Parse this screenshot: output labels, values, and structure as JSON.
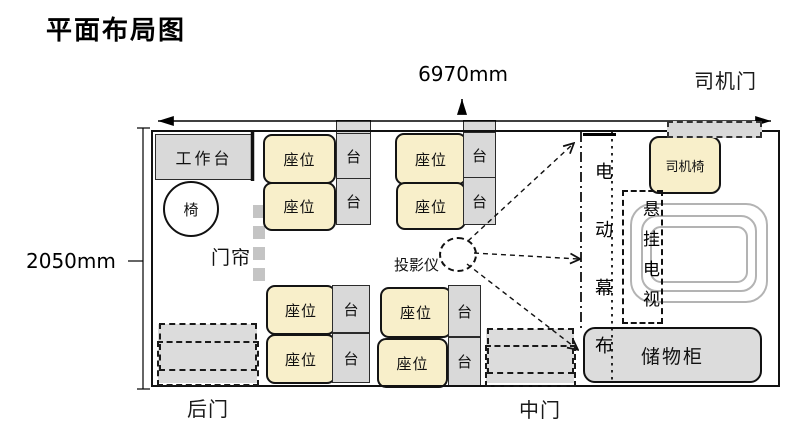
{
  "title": "平面布局图",
  "dimensions": {
    "width_label": "6970mm",
    "height_label": "2050mm"
  },
  "doors": {
    "driver": "司机门",
    "rear": "后门",
    "middle": "中门"
  },
  "furniture": {
    "workbench": "工作台",
    "chair": "椅",
    "curtain": "门帘",
    "seat": "座位",
    "side_table": "台",
    "projector": "投影仪",
    "electric_screen": "电动幕布",
    "driver_chair": "司机椅",
    "hanging_tv": "悬挂电视",
    "storage_cabinet": "储物柜"
  },
  "colors": {
    "seat_fill": "#f8efca",
    "furniture_fill": "#d9d9d9",
    "door_fill": "#dcdcdc",
    "tv_outline": "#b3b3b3",
    "line": "#111111"
  }
}
